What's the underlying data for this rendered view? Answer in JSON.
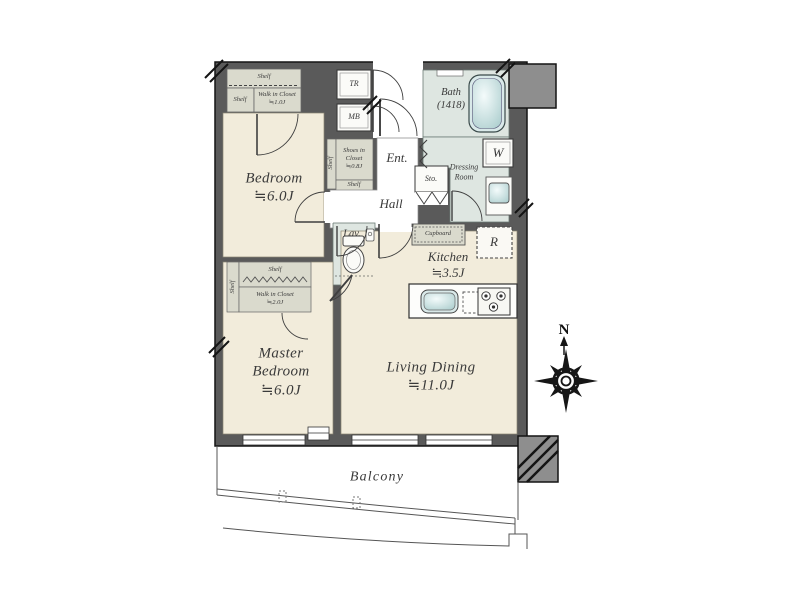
{
  "colors": {
    "wall": "#5a5a5a",
    "column": "#8e8e8e",
    "room_floor": "#f2ecdb",
    "wet_floor": "#dee6e1",
    "closet_floor": "#dadacd",
    "fixture": "#cfe3e3",
    "outline": "#141414",
    "label_text": "#3a3a3a"
  },
  "labels": {
    "bedroom": "Bedroom\n≒6.0J",
    "master_bedroom": "Master\nBedroom\n≒6.0J",
    "living_dining": "Living Dining\n≒11.0J",
    "kitchen": "Kitchen\n≒3.5J",
    "bath": "Bath\n(1418)",
    "dressing_room": "Dressing\nRoom",
    "hall": "Hall",
    "entrance": "Ent.",
    "lavatory": "Lav.",
    "storage": "Sto.",
    "trunk_room": "TR",
    "meter_box": "MB",
    "washing_machine": "W",
    "refrigerator": "R",
    "cupboard": "Cupboard",
    "balcony": "Balcony",
    "compass_north": "N",
    "bedroom_closet": {
      "shelf_top": "Shelf",
      "shelf_side": "Shelf",
      "walk_in": "Walk in Closet\n≒1.0J"
    },
    "master_closet": {
      "shelf_top": "Shelf",
      "shelf_side": "Shelf",
      "walk_in": "Walk in Closet\n≒2.0J"
    },
    "shoes_closet": {
      "shelf_side": "Shelf",
      "name": "Shoes in\nCloset\n≒0.8J",
      "shelf_bottom": "Shelf"
    }
  }
}
